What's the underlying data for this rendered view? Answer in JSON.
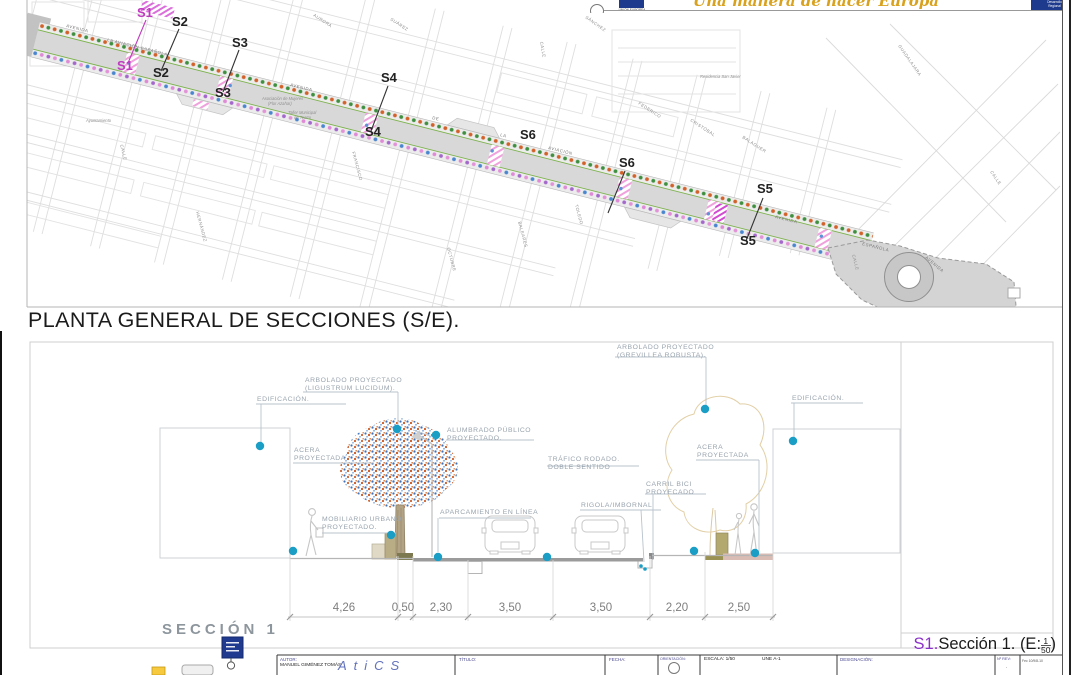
{
  "header": {
    "eu_caption": "UNIÓN EUROPEA",
    "slogan": "Una manera de hacer Europa",
    "right_box_line1": "Desarrollo",
    "right_box_line2": "Regional"
  },
  "plan": {
    "title": "PLANTA GENERAL DE SECCIONES (S/E).",
    "section_markers": [
      {
        "text": "S1",
        "x": 137,
        "y": 17,
        "color": "#c03ac0"
      },
      {
        "text": "S2",
        "x": 172,
        "y": 26,
        "color": "#222222"
      },
      {
        "text": "S3",
        "x": 232,
        "y": 47,
        "color": "#222222"
      },
      {
        "text": "S1",
        "x": 117,
        "y": 70,
        "color": "#c03ac0"
      },
      {
        "text": "S2",
        "x": 153,
        "y": 77,
        "color": "#222222"
      },
      {
        "text": "S3",
        "x": 215,
        "y": 97,
        "color": "#222222"
      },
      {
        "text": "S4",
        "x": 381,
        "y": 82,
        "color": "#222222"
      },
      {
        "text": "S4",
        "x": 365,
        "y": 136,
        "color": "#222222"
      },
      {
        "text": "S6",
        "x": 520,
        "y": 139,
        "color": "#222222"
      },
      {
        "text": "S6",
        "x": 619,
        "y": 167,
        "color": "#222222"
      },
      {
        "text": "S5",
        "x": 757,
        "y": 193,
        "color": "#222222"
      },
      {
        "text": "S5",
        "x": 740,
        "y": 245,
        "color": "#222222"
      }
    ],
    "avenue_labels": [
      {
        "text": "AVENIDA",
        "x": 66,
        "y": 27,
        "r": 14
      },
      {
        "text": "LA AVIACIÓN ESPAÑOLA",
        "x": 107,
        "y": 41,
        "r": 14
      },
      {
        "text": "AVENIDA",
        "x": 290,
        "y": 86,
        "r": 14
      },
      {
        "text": "DE",
        "x": 432,
        "y": 119,
        "r": 14
      },
      {
        "text": "LA",
        "x": 500,
        "y": 136,
        "r": 14
      },
      {
        "text": "AVIACIÓN",
        "x": 548,
        "y": 149,
        "r": 14
      },
      {
        "text": "AVENIDA",
        "x": 775,
        "y": 218,
        "r": 14
      },
      {
        "text": "ESPAÑOLA",
        "x": 862,
        "y": 245,
        "r": 14
      },
      {
        "text": "AVENIDA",
        "x": 925,
        "y": 258,
        "r": 40
      }
    ],
    "street_labels": [
      {
        "text": "SÁNCHEZ",
        "x": 585,
        "y": 18,
        "r": 35
      },
      {
        "text": "CALLE",
        "x": 540,
        "y": 42,
        "r": 80
      },
      {
        "text": "AURORA",
        "x": 313,
        "y": 16,
        "r": 33
      },
      {
        "text": "SUÁREZ",
        "x": 390,
        "y": 20,
        "r": 33
      },
      {
        "text": "FEDERICO",
        "x": 638,
        "y": 104,
        "r": 33
      },
      {
        "text": "CRISTÓBAL",
        "x": 690,
        "y": 121,
        "r": 33
      },
      {
        "text": "BALAGUER",
        "x": 742,
        "y": 138,
        "r": 33
      },
      {
        "text": "GUADALAJARA",
        "x": 898,
        "y": 46,
        "r": 55
      },
      {
        "text": "CALLE",
        "x": 852,
        "y": 255,
        "r": 75
      },
      {
        "text": "CALLE",
        "x": 990,
        "y": 172,
        "r": 55
      },
      {
        "text": "HERNÁNDEZ",
        "x": 196,
        "y": 212,
        "r": 75
      },
      {
        "text": "FRANCISCO",
        "x": 352,
        "y": 152,
        "r": 75
      },
      {
        "text": "BALEARES",
        "x": 518,
        "y": 222,
        "r": 75
      },
      {
        "text": "OCTUBRE",
        "x": 447,
        "y": 248,
        "r": 75
      },
      {
        "text": "TOLEDO",
        "x": 575,
        "y": 205,
        "r": 75
      },
      {
        "text": "CALLE",
        "x": 120,
        "y": 145,
        "r": 75
      }
    ],
    "landmark_labels": [
      {
        "text": "Residencia San Javier",
        "x": 700,
        "y": 78,
        "r": 0
      },
      {
        "text": "Ayuntamiento",
        "x": 86,
        "y": 122,
        "r": 0
      },
      {
        "text": "Asociación de Mujeres",
        "x": 262,
        "y": 100,
        "r": 0
      },
      {
        "text": "(Flor Azahar)",
        "x": 268,
        "y": 105,
        "r": 0
      },
      {
        "text": "Taller Municipal",
        "x": 288,
        "y": 114,
        "r": 0
      },
      {
        "text": "de Teatro",
        "x": 294,
        "y": 119,
        "r": 0
      }
    ]
  },
  "section": {
    "panel_name": "SECCIÓN 1",
    "caption": {
      "prefix": "S1.",
      "text": "Sección 1. (E:",
      "num": "1",
      "den": "50",
      "suffix": ")"
    },
    "annotations": [
      {
        "lines": [
          "ARBOLADO PROYECTADO",
          "(LIGUSTRUM LUCIDUM)."
        ],
        "x": 305,
        "y": 382
      },
      {
        "lines": [
          "ARBOLADO PROYECTADO",
          "(GREVILLEA ROBUSTA)."
        ],
        "x": 617,
        "y": 349
      },
      {
        "lines": [
          "EDIFICACIÓN."
        ],
        "x": 257,
        "y": 401
      },
      {
        "lines": [
          "EDIFICACIÓN."
        ],
        "x": 792,
        "y": 400
      },
      {
        "lines": [
          "ALUMBRADO PÚBLICO",
          "PROYECTADO."
        ],
        "x": 447,
        "y": 432
      },
      {
        "lines": [
          "ACERA",
          "PROYECTADA"
        ],
        "x": 294,
        "y": 452
      },
      {
        "lines": [
          "ACERA",
          "PROYECTADA"
        ],
        "x": 697,
        "y": 449
      },
      {
        "lines": [
          "TRÁFICO RODADO.",
          "DOBLE SENTIDO"
        ],
        "x": 548,
        "y": 461
      },
      {
        "lines": [
          "CARRIL BICI",
          "PROYECADO"
        ],
        "x": 646,
        "y": 486
      },
      {
        "lines": [
          "RIGOLA/IMBORNAL"
        ],
        "x": 581,
        "y": 507
      },
      {
        "lines": [
          "APARCAMIENTO EN LÍNEA"
        ],
        "x": 440,
        "y": 514
      },
      {
        "lines": [
          "MOBILIARIO URBANO",
          "PROYECTADO."
        ],
        "x": 322,
        "y": 521
      }
    ],
    "dimensions": [
      {
        "value": "4,26",
        "x": 344
      },
      {
        "value": "0,50",
        "x": 403
      },
      {
        "value": "2,30",
        "x": 441
      },
      {
        "value": "3,50",
        "x": 510
      },
      {
        "value": "3,50",
        "x": 601
      },
      {
        "value": "2,20",
        "x": 677
      },
      {
        "value": "2,50",
        "x": 739
      }
    ]
  },
  "titleblock": {
    "autor_label": "AUTOR:",
    "autor": "MANUEL GIMÉNEZ TOMÁS",
    "logo_letters": "AtiCS",
    "titulo_label": "TÍTULO:",
    "fecha_label": "FECHA:",
    "orientacion_label": "ORIENTACIÓN:",
    "escala": "ESCALA: 1/50",
    "formato": "UNE A-1",
    "designacion_label": "DESIGNACIÓN:",
    "nrev_label": "Nº REV:",
    "nrev_value": ".",
    "ref": "Fec 10/9/8-10"
  },
  "palette": {
    "accent_dot": "#1b9ec6",
    "tree_orange": "#d2622a",
    "tree_green": "#3f8f3f",
    "tree_blue": "#4a86d0",
    "tree_pink": "#df8ad6",
    "tree_violet": "#a468cc",
    "crosswalk_pink": "#f0a0dc",
    "marker_magenta": "#c03ac0"
  }
}
